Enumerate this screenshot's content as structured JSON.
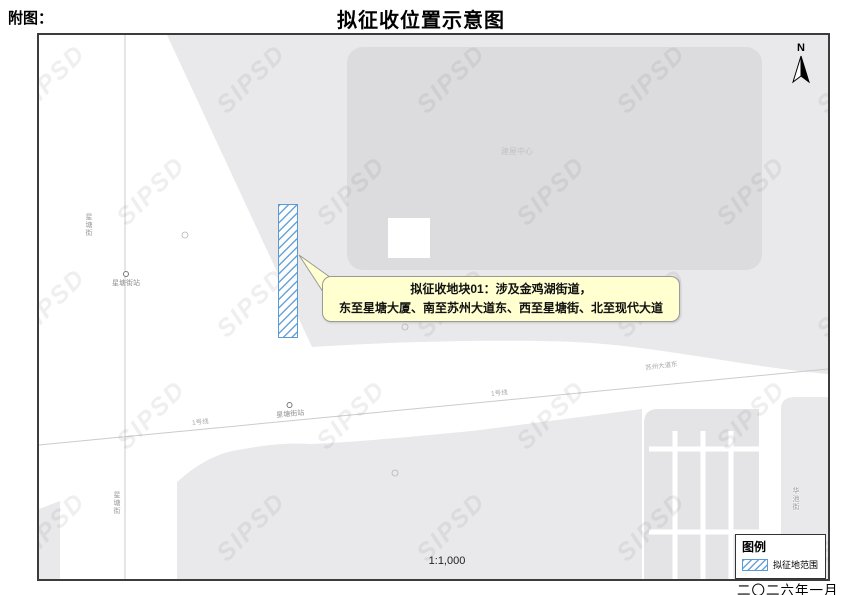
{
  "header": {
    "prefix": "附图：",
    "title": "拟征收位置示意图"
  },
  "map": {
    "watermark": "SIPSD",
    "north_label": "N",
    "scale_text": "1:1,000",
    "labels": {
      "xingtang_street_n": "星塘街",
      "xingtang_street_s": "星塘街",
      "xingtang_station_w": "星塘街站",
      "xingtang_station_line": "星塘街站",
      "metro_line_w": "1号线",
      "metro_line_e": "1号线",
      "suzhou_avenue_east": "苏州大道东",
      "huachi_street": "华池街",
      "building_center": "建屋中心"
    },
    "callout": {
      "line1": "拟征收地块01：涉及金鸡湖街道，",
      "line2": "东至星塘大厦、南至苏州大道东、西至星塘街、北至现代大道"
    },
    "colors": {
      "parcel_hatch_blue": "#5b9bd5",
      "callout_bg": "#ffffd0",
      "block_light": "#e9e9eb",
      "block_dark": "#dcdcde"
    }
  },
  "legend": {
    "title": "图例",
    "item": "拟征地范围"
  },
  "footer": {
    "date": "二〇二六年一月"
  }
}
